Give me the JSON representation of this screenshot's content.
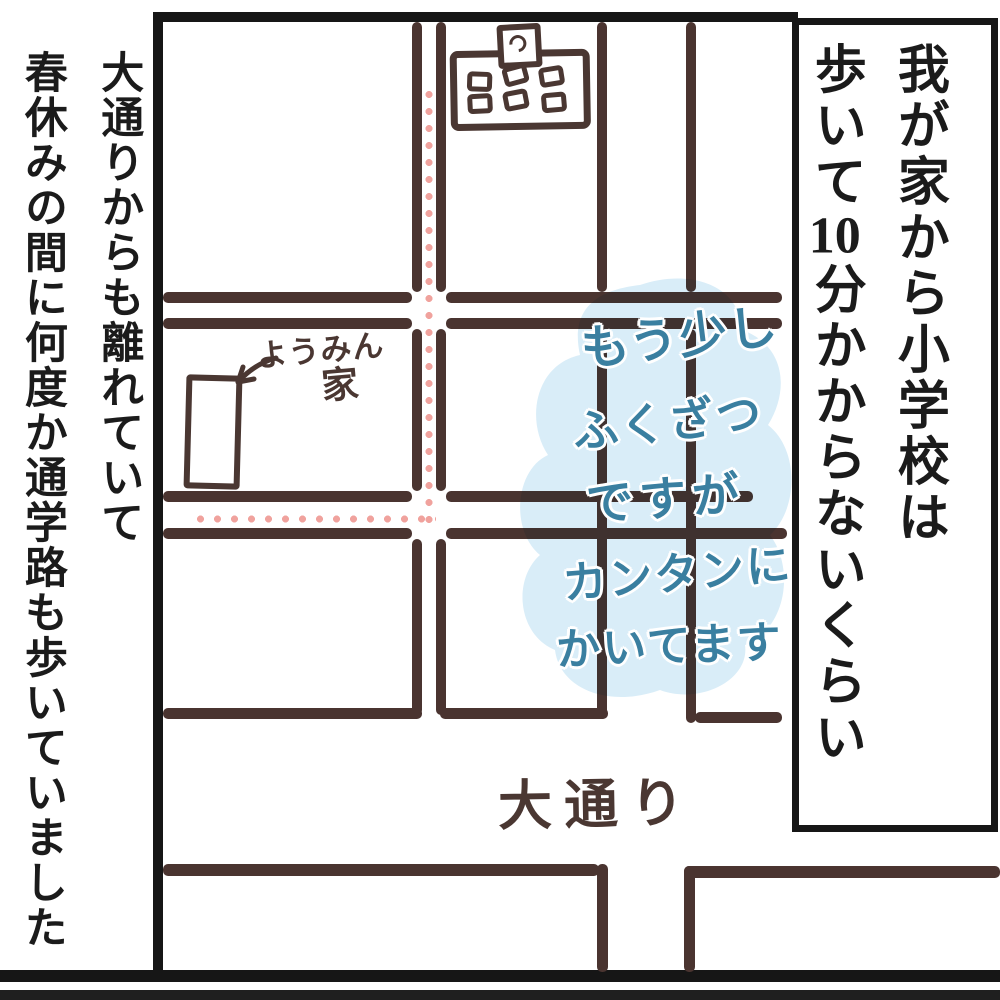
{
  "left_caption": {
    "col1": "大通りからも離れていて",
    "col2": "春休みの間に何度か通学路も歩いていました"
  },
  "right_caption": {
    "col1": "我が家から小学校は",
    "col2_pre": "歩いて",
    "col2_num": "10",
    "col2_post": "分かからないくらい"
  },
  "map": {
    "house_label_kana": "ようみん",
    "house_label_kanji": "家",
    "road_label": "大通り",
    "note_lines": [
      "もう少し",
      "ふくざつ",
      "ですが",
      "カンタンに",
      "かいてます"
    ]
  },
  "colors": {
    "street": "#4a3430",
    "frame": "#161616",
    "hand_ink": "#4a3732",
    "caption_ink": "#1b1b1b",
    "route_dots": "#f0a29d",
    "note_text": "#3a7fa0",
    "note_bubble": "#d9edf8"
  }
}
